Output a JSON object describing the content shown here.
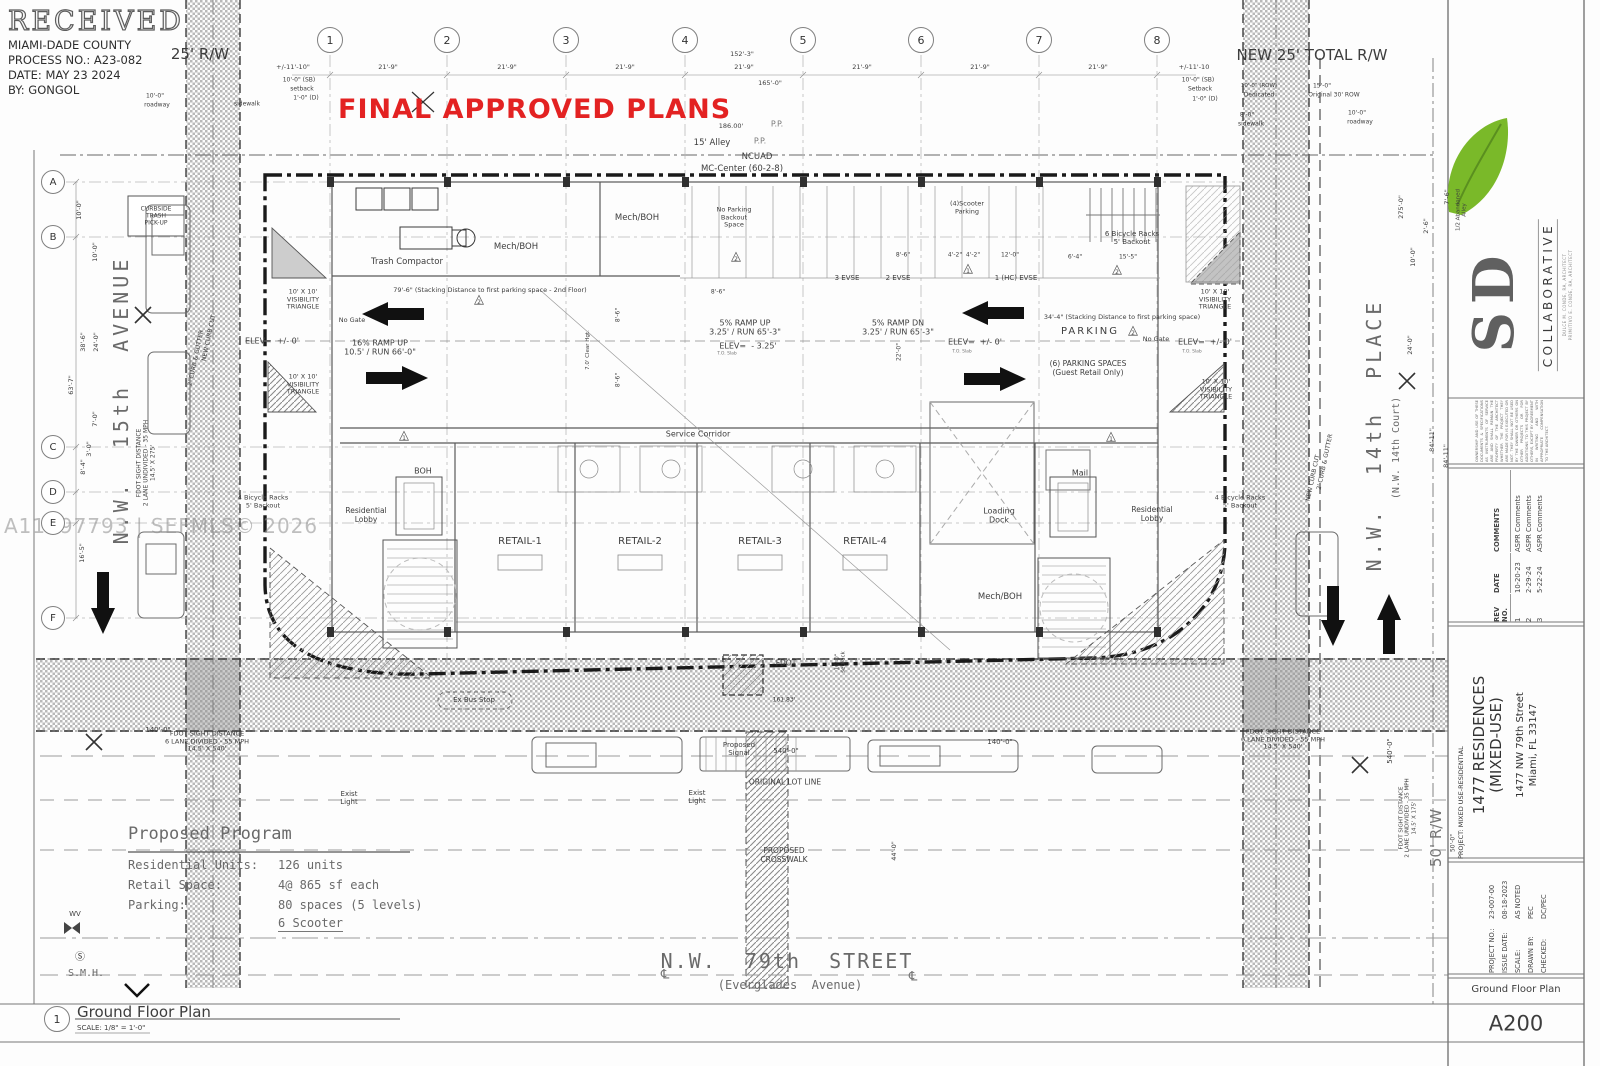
{
  "colors": {
    "accent_red": "#e32222",
    "leaf_green": "#7ab929",
    "paper": "#fdfdfd",
    "line_gray": "#4a4a4a",
    "hatch_gray": "#b5b5b5",
    "watermark_gray": "#969696"
  },
  "stamp": {
    "received": "RECEIVED",
    "agency": "MIAMI-DADE COUNTY",
    "process": "PROCESS NO.: A23-082",
    "date": "DATE: MAY 23 2024",
    "by": "BY: GONGOL"
  },
  "banner": {
    "approved": "FINAL APPROVED PLANS"
  },
  "watermark": "A11097793 | SEFMLS© 2026",
  "grid": {
    "cols": [
      "1",
      "2",
      "3",
      "4",
      "5",
      "6",
      "7",
      "8"
    ],
    "rows": [
      "A",
      "B",
      "C",
      "D",
      "E",
      "F"
    ]
  },
  "topdims": {
    "end_left": "+/-11'-10\"",
    "bay": "21'-9\"",
    "overall_upper": "152'-3\"",
    "overall_lower": "165'-0\"",
    "end_right": "+/-11'-10",
    "rw_left": "25' R/W",
    "rw_right": "NEW 25' TOTAL R/W",
    "alley_len": "186.00'",
    "alley": "15' Alley",
    "ncuad": "NCUAD",
    "mc_center": "MC-Center (60-2-8)",
    "pp": "P.P.",
    "sb": "10'-0\" (SB)",
    "setback_lc": "setback",
    "setback_uc": "Setback",
    "d_1_0": "1'-0\" (D)",
    "roadway_dim": "10'-0\"",
    "roadway": "roadway",
    "sidewalk_dim": "8'-0\"",
    "sidewalk": "sidewalk",
    "row_dim": "10'-0\" (ROW)",
    "dedicated": "Dedicated",
    "orig_row_dim": "15'-0\"",
    "orig_row": "Original 30' ROW"
  },
  "plan": {
    "trash_compactor": "Trash Compactor",
    "mech_boh": "Mech/BOH",
    "no_parking": "No Parking\nBackout\nSpace",
    "scooter": "(4)Scooter\nParking",
    "evse3": "3 EVSE",
    "evse2": "2 EVSE",
    "evse1": "1 (HC) EVSE",
    "bikes6": "6 Bicycle Racks\n5' Backout",
    "bikes4": "4 Bicycle Racks\n5' Backout",
    "ramp16": "16% RAMP UP\n10.5' / RUN 66'-0\"",
    "ramp_up5": "5% RAMP UP\n3.25' / RUN 65'-3\"",
    "ramp_dn5": "5% RAMP DN\n3.25' / RUN 65'-3\"",
    "elev_0": "ELEV=  +/- 0'",
    "elev_neg": "ELEV=  - 3.25'",
    "to_slab": "T.O. Slab",
    "no_gate": "No Gate",
    "parking": "PARKING",
    "guest_parking": "(6) PARKING SPACES\n(Guest Retail Only)",
    "visibility": "10' X 10'\nVISIBILITY\nTRIANGLE",
    "stack_79": "79'-6\" (Stacking Distance to first parking space - 2nd Floor)",
    "stack_34": "34'-4\" (Stacking Distance to first parking space)",
    "clear_hgt": "7.0' Clear Hgt.",
    "service_corridor": "Service Corridor",
    "boh": "BOH",
    "res_lobby": "Residential\nLobby",
    "retail1": "RETAIL-1",
    "retail2": "RETAIL-2",
    "retail3": "RETAIL-3",
    "retail4": "RETAIL-4",
    "loading": "Loading\nDock",
    "mail": "Mail",
    "curbside": "CURBSIDE\nTRASH\nPICK-UP",
    "keynote_glyph": "△",
    "keynote1": "1",
    "keynote2": "2",
    "dim_8_6": "8'-6\"",
    "dim_4_2": "4'-2\"",
    "dim_12_0": "12'-0\"",
    "dim_6_4": "6'-4\"",
    "dim_15_5": "15'-5\"",
    "dim_22_0": "22'-0\""
  },
  "streets": {
    "left_name": "N.W.  15th  AVENUE",
    "left_fdot": "FDOT SIGHT DISTANCE\n2 LANE UNDIVIDED - 35 MPH\n14.5' X 275'",
    "curb_gutter": "2' CURB & GUTTER",
    "curb_cut": "NEW CURB CUT",
    "right_name": "N.W.  14th  PLACE",
    "right_court": "(N.W. 14th Court)",
    "right_fdot": "FDOT SIGHT DISTANCE\n2 LANE UNDIVIDED - 35 MPH\n14.5' X 175'",
    "bottom_name": "N.W.  79th  STREET",
    "bottom_alt": "(Everglades  Avenue)",
    "bottom_fdot": "FDOT SIGHT DISTANCE\n6 LANE DIVIDED - 55 MPH\n14.5' X 540'",
    "bus_stop": "Ex Bus Stop",
    "fdot": "FDOT",
    "lot_len": "161.83'",
    "signal": "Proposed\nSignal",
    "d540": "540'-0\"",
    "lot_line": "ORIGINAL LOT LINE",
    "crosswalk": "PROPOSED\nCROSSWALK",
    "exist_light": "Exist\nLight",
    "d140": "140'-0\"",
    "d44": "44'-0\"",
    "rw50": "50' R/W",
    "d50": "50'-0\"",
    "wv": "WV",
    "smh_sym": "Ⓢ",
    "smh": "S.M.H.",
    "cl": "℄"
  },
  "leftdims": [
    "10'-0\"",
    "10'-0\"",
    "38'-6\"",
    "24'-0\"",
    "63'-7\"",
    "7'-0\"",
    "3'-0\"",
    "8'-4\"",
    "16'-5\""
  ],
  "rightdims": {
    "d275": "275'-0\"",
    "d7_6": "7'-6\"",
    "d2_6": "2'-6\"",
    "d10": "10'-0\"",
    "d24": "24'-0\"",
    "d84": "84'-11\"",
    "abandoned": "1/2 Abandoned\nAlley",
    "setback_rot": "10'-0\"\nsetback"
  },
  "program": {
    "title": "Proposed Program",
    "rows": [
      [
        "Residential Units:",
        "126 units"
      ],
      [
        "Retail Space:",
        "4@ 865 sf each"
      ],
      [
        "Parking:",
        "80 spaces (5 levels)"
      ],
      [
        "",
        "6 Scooter"
      ]
    ]
  },
  "plantitle": {
    "num": "1",
    "name": "Ground Floor Plan",
    "scale": "SCALE: 1/8\" = 1'-0\""
  },
  "titleblock": {
    "sd": "SD",
    "collaborative": "COLLABORATIVE",
    "architects": "DULCE M. CONDE, RA, ARCHITECT\nPRIMITIVO E. CONDE, RA, ARCHITECT",
    "ownership": "OWNERSHIP AND USE OF THESE DOCUMENTS & SPECIFICATIONS AS INSTRUMENTS OF SERVICE ARE AND SHALL REMAIN THE PROPERTY OF THE ARCHITECT WHETHER THE PROJECT THEY ARE MADE FOR IS EXECUTED OR NOT. THEY SHALL NOT BE USED BY THE OWNER OR OTHERS ON OTHER PROJECTS OR FOR ADDITIONS TO THIS PROJECT BY OTHERS, EXCEPT BY AGREEMENT IN WRITING AND WITH APPROPRIATE COMPENSATION TO THE ARCHITECT.",
    "rev_headers": [
      "REV NO.",
      "DATE",
      "COMMENTS"
    ],
    "revisions": [
      [
        "1",
        "10-20-23",
        "ASPR Comments"
      ],
      [
        "2",
        "2-29-24",
        "ASPR Comments"
      ],
      [
        "3",
        "5-22-24",
        "ASPR Comments"
      ]
    ],
    "project_type": "PROJECT: MIXED USE-RESIDENTIAL",
    "project_name": "1477 RESIDENCES\n(MIXED-USE)",
    "address": "1477 NW 79th Street\nMiami, FL 33147",
    "info": [
      [
        "PROJECT NO.:",
        "23-007-00"
      ],
      [
        "ISSUE DATE:",
        "08-18-2023"
      ],
      [
        "SCALE:",
        "AS NOTED"
      ],
      [
        "DRAWN BY:",
        "PEC"
      ],
      [
        "CHECKED:",
        "DC/PEC"
      ]
    ],
    "sheet_name": "Ground Floor Plan",
    "sheet_no": "A200"
  }
}
